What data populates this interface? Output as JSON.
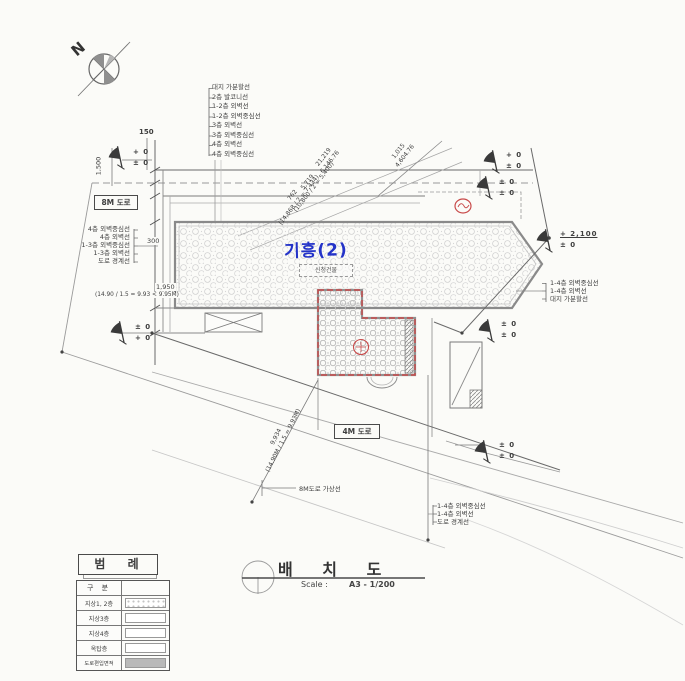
{
  "drawing": {
    "north_label": "N",
    "building_label": "기흥(2)",
    "building_box_label": "신청건물",
    "road_8m_label": "8M 도로",
    "road_4m_label": "4M 도로",
    "road_8m_virtual_label": "8M도로 가상선"
  },
  "callouts": {
    "top_stack": [
      "대지 가분할선",
      "2층 발코니선",
      "1-2층 외벽선",
      "1-2층 외벽중심선",
      "3층 외벽선",
      "3층 외벽중심선",
      "4층 외벽선",
      "4층 외벽중심선"
    ],
    "left_stack": [
      "4층 외벽중심선",
      "4층 외벽선",
      "1-3층 외벽중심선",
      "1-3층 외벽선",
      "도로 경계선"
    ],
    "right_stack": [
      "1-4층 외벽중심선",
      "1-4층 외벽선",
      "대지 가분할선"
    ],
    "bottom_right_stack": [
      "1-4층 외벽중심선",
      "1-4층 외벽선",
      "도로 경계선"
    ]
  },
  "levels": {
    "top_left": {
      "top": "+ 0",
      "bottom": "± 0"
    },
    "left_mid": {
      "top": "± 0",
      "bottom": "+ 0"
    },
    "top_right1": {
      "top": "+ 0",
      "bottom": "± 0"
    },
    "top_right2": {
      "top": "± 0",
      "bottom": "± 0"
    },
    "right": {
      "top": "+ 2,100",
      "bottom": "± 0"
    },
    "right_mid": {
      "top": "± 0",
      "bottom": "± 0"
    },
    "bottom": {
      "top": "± 0",
      "bottom": "± 0"
    }
  },
  "dimensions": {
    "d150": "150",
    "d1500": "1,500",
    "d300": "300",
    "d1950": "1,950",
    "calc_left": "(14.90 / 1.5 = 9.93 < 9.95M)",
    "diag1": {
      "a": "21,219",
      "b": "6,146.76"
    },
    "diag2": {
      "a": "5,719",
      "b": "(10,800 / 2 = 5,400)"
    },
    "diag3": {
      "a": "762",
      "b": "(14,868 / 2 = 7,434)"
    },
    "diag4": {
      "a": "1,015",
      "b": "4,604.76"
    },
    "diag5": {
      "a": "9,934",
      "b": "(14.90M / 1.5 = 9.93M)"
    }
  },
  "legend": {
    "title": "범 례",
    "header": "구 분",
    "rows": [
      {
        "label": "지상1, 2층"
      },
      {
        "label": "지상3층"
      },
      {
        "label": "지상4층"
      },
      {
        "label": "옥탑층"
      },
      {
        "label": "도로편입면적"
      }
    ]
  },
  "titleblock": {
    "title": "배 치 도",
    "scale_label": "Scale :",
    "scale_value": "A3 - 1/200"
  },
  "colors": {
    "accent_blue": "#2433c8",
    "accent_red": "#c84a4a",
    "line": "#555555"
  }
}
